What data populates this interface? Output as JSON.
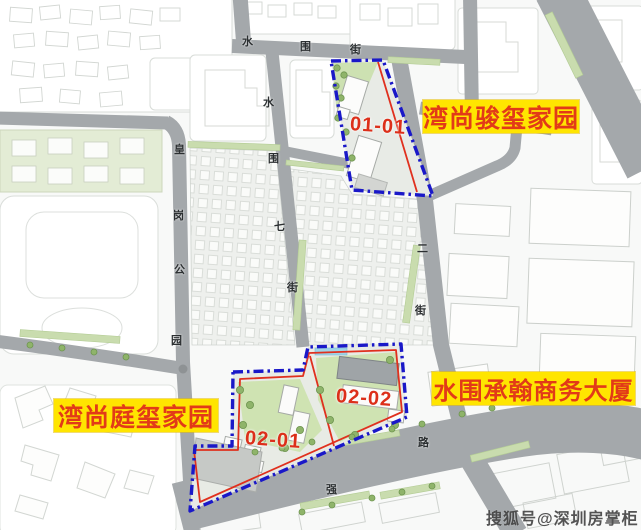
{
  "labels": {
    "top_right": "湾尚骏玺家园",
    "right": "水围承翰商务大厦",
    "bottom_left": "湾尚庭玺家园"
  },
  "plot_ids": {
    "p0101": "01-01",
    "p0202": "02-02",
    "p0201": "02-01"
  },
  "streets": {
    "shuiwei_jie": [
      "水",
      "围",
      "街"
    ],
    "shuiwei_qi_jie": [
      "水",
      "围",
      "七",
      "街"
    ],
    "huanggang_gongyuan": [
      "皇",
      "岗",
      "公",
      "园"
    ],
    "er_jie": [
      "二",
      "街"
    ],
    "qiang": "强",
    "lu": "路"
  },
  "watermark": "搜狐号@深圳房掌柜",
  "colors": {
    "label_bg": "#FFE500",
    "label_text": "#E23A18",
    "plot_boundary_blue": "#1A18C8",
    "plot_boundary_red": "#E0301E",
    "road_gray": "#A4A8AB",
    "green_landscape": "#CFE3B2",
    "map_background": "#F8F9F8"
  }
}
